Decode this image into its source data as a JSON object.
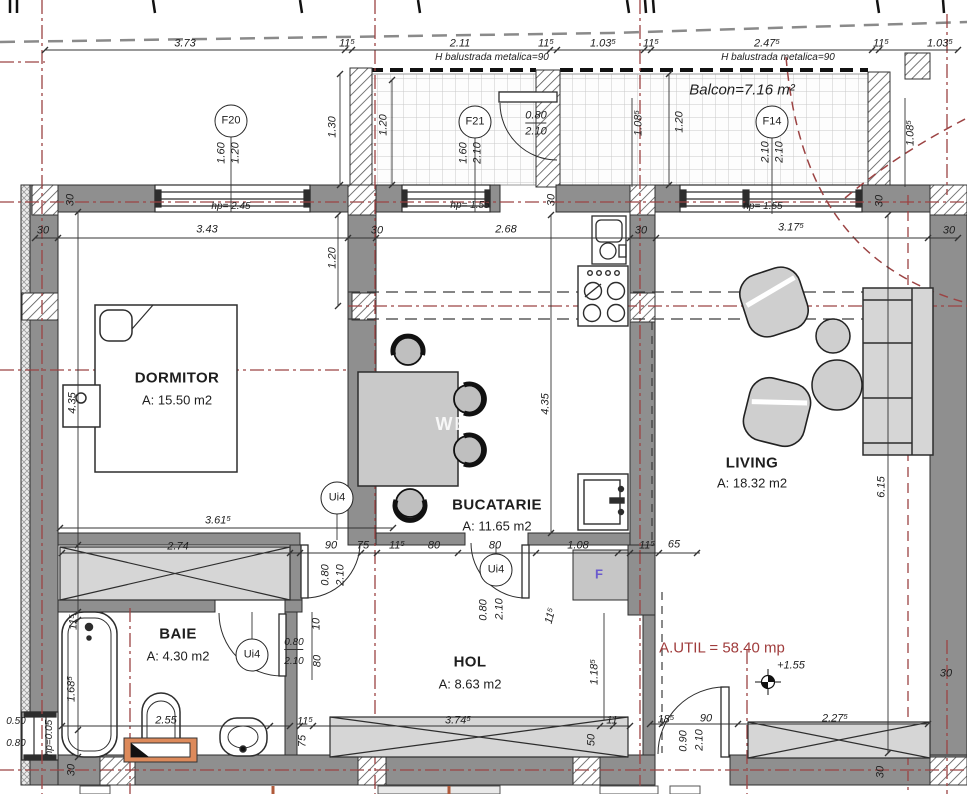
{
  "plan": {
    "rooms": [
      {
        "name": "DORMITOR",
        "area": "A: 15.50 m2"
      },
      {
        "name": "BUCATARIE",
        "area": "A: 11.65 m2"
      },
      {
        "name": "LIVING",
        "area": "A: 18.32 m2"
      },
      {
        "name": "BAIE",
        "area": "A: 4.30 m2"
      },
      {
        "name": "HOL",
        "area": "A: 8.63 m2"
      }
    ],
    "balcony": "Balcon=7.16 m²",
    "total_usable_area": "A.UTIL = 58.40 mp",
    "level_mark": "+1.55",
    "colors": {
      "wall": "#8f8f8f",
      "axis_red": "#9c4343",
      "vanity_orange": "#dd8a5b",
      "fridge_letter": "#6a5acd"
    }
  },
  "labels": [
    {
      "t": "3.73",
      "x": 185,
      "y": 44,
      "k": "dim"
    },
    {
      "t": "11⁵",
      "x": 347,
      "y": 44,
      "k": "dim"
    },
    {
      "t": "2.11",
      "x": 460,
      "y": 44,
      "k": "dim"
    },
    {
      "t": "11⁵",
      "x": 546,
      "y": 44,
      "k": "dim"
    },
    {
      "t": "1.03⁵",
      "x": 603,
      "y": 44,
      "k": "dim"
    },
    {
      "t": "11⁵",
      "x": 651,
      "y": 44,
      "k": "dim"
    },
    {
      "t": "2.47⁵",
      "x": 767,
      "y": 44,
      "k": "dim"
    },
    {
      "t": "11⁵",
      "x": 881,
      "y": 44,
      "k": "dim"
    },
    {
      "t": "1.03⁵",
      "x": 940,
      "y": 44,
      "k": "dim"
    },
    {
      "t": "H balustrada metalica=90",
      "x": 492,
      "y": 58,
      "k": "small"
    },
    {
      "t": "H balustrada metalica=90",
      "x": 778,
      "y": 58,
      "k": "small"
    },
    {
      "t": "Balcon=7.16 m²",
      "x": 742,
      "y": 90,
      "k": "balcony"
    },
    {
      "t": "F20",
      "x": 231,
      "y": 121,
      "k": "marker"
    },
    {
      "t": "F21",
      "x": 475,
      "y": 122,
      "k": "marker"
    },
    {
      "t": "F14",
      "x": 772,
      "y": 122,
      "k": "marker"
    },
    {
      "t": "1.60",
      "x": 222,
      "y": 153,
      "r": -90,
      "k": "dim"
    },
    {
      "t": "1.20",
      "x": 236,
      "y": 153,
      "r": -90,
      "k": "dim"
    },
    {
      "t": "1.60",
      "x": 464,
      "y": 153,
      "r": -90,
      "k": "dim"
    },
    {
      "t": "2.10",
      "x": 478,
      "y": 153,
      "r": -90,
      "k": "dim"
    },
    {
      "t": "2.10",
      "x": 766,
      "y": 152,
      "r": -90,
      "k": "dim"
    },
    {
      "t": "2.10",
      "x": 780,
      "y": 152,
      "r": -90,
      "k": "dim"
    },
    {
      "t": "1.30",
      "x": 333,
      "y": 127,
      "r": -90,
      "k": "dim"
    },
    {
      "t": "1.20",
      "x": 384,
      "y": 125,
      "r": -90,
      "k": "dim"
    },
    {
      "t": "1.20",
      "x": 680,
      "y": 122,
      "r": -90,
      "k": "dim"
    },
    {
      "t": "1.08⁵",
      "x": 639,
      "y": 123,
      "r": -90,
      "k": "dim"
    },
    {
      "t": "1.08⁵",
      "x": 911,
      "y": 133,
      "r": -90,
      "k": "dim"
    },
    {
      "t": "0.80",
      "x": 536,
      "y": 117,
      "k": "dim fractop"
    },
    {
      "t": "2.10",
      "x": 536,
      "y": 132,
      "k": "dim"
    },
    {
      "t": "hp= 2.45",
      "x": 231,
      "y": 207,
      "k": "small"
    },
    {
      "t": "hp= 1.55",
      "x": 470,
      "y": 206,
      "k": "small"
    },
    {
      "t": "hp= 1.55",
      "x": 763,
      "y": 207,
      "k": "small"
    },
    {
      "t": "30",
      "x": 43,
      "y": 231,
      "k": "dim"
    },
    {
      "t": "3.43",
      "x": 207,
      "y": 230,
      "k": "dim"
    },
    {
      "t": "30",
      "x": 377,
      "y": 231,
      "k": "dim"
    },
    {
      "t": "2.68",
      "x": 506,
      "y": 230,
      "k": "dim"
    },
    {
      "t": "30",
      "x": 641,
      "y": 231,
      "k": "dim"
    },
    {
      "t": "3.17⁵",
      "x": 791,
      "y": 228,
      "k": "dim"
    },
    {
      "t": "30",
      "x": 949,
      "y": 231,
      "k": "dim"
    },
    {
      "t": "30",
      "x": 71,
      "y": 200,
      "r": -90,
      "k": "dim"
    },
    {
      "t": "30",
      "x": 552,
      "y": 200,
      "r": -90,
      "k": "dim"
    },
    {
      "t": "30",
      "x": 880,
      "y": 201,
      "r": -90,
      "k": "dim"
    },
    {
      "t": "30",
      "x": 72,
      "y": 770,
      "r": -90,
      "k": "dim"
    },
    {
      "t": "30",
      "x": 881,
      "y": 772,
      "r": -90,
      "k": "dim"
    },
    {
      "t": "30",
      "x": 946,
      "y": 674,
      "k": "dim"
    },
    {
      "t": "1.20",
      "x": 333,
      "y": 258,
      "r": -90,
      "k": "dim"
    },
    {
      "t": "4.35",
      "x": 73,
      "y": 403,
      "r": -90,
      "k": "dim"
    },
    {
      "t": "4.35",
      "x": 546,
      "y": 404,
      "r": -90,
      "k": "dim"
    },
    {
      "t": "6.15",
      "x": 882,
      "y": 487,
      "r": -90,
      "k": "dim"
    },
    {
      "t": "DORMITOR",
      "x": 177,
      "y": 378,
      "k": "room"
    },
    {
      "t": "A: 15.50 m2",
      "x": 177,
      "y": 400,
      "k": "area"
    },
    {
      "t": "BUCATARIE",
      "x": 497,
      "y": 505,
      "k": "room"
    },
    {
      "t": "A: 11.65 m2",
      "x": 497,
      "y": 526,
      "k": "area"
    },
    {
      "t": "LIVING",
      "x": 752,
      "y": 463,
      "k": "room"
    },
    {
      "t": "A: 18.32 m2",
      "x": 752,
      "y": 483,
      "k": "area"
    },
    {
      "t": "BAIE",
      "x": 178,
      "y": 634,
      "k": "room"
    },
    {
      "t": "A: 4.30 m2",
      "x": 178,
      "y": 656,
      "k": "area"
    },
    {
      "t": "HOL",
      "x": 470,
      "y": 662,
      "k": "room"
    },
    {
      "t": "A: 8.63 m2",
      "x": 470,
      "y": 684,
      "k": "area"
    },
    {
      "t": "A.UTIL = 58.40 mp",
      "x": 722,
      "y": 648,
      "k": "red"
    },
    {
      "t": "+1.55",
      "x": 791,
      "y": 666,
      "k": "dim"
    },
    {
      "t": "Ui4",
      "x": 337,
      "y": 498,
      "k": "marker"
    },
    {
      "t": "Ui4",
      "x": 496,
      "y": 570,
      "k": "marker"
    },
    {
      "t": "Ui4",
      "x": 252,
      "y": 655,
      "k": "marker"
    },
    {
      "t": "3.61⁵",
      "x": 218,
      "y": 521,
      "k": "dim"
    },
    {
      "t": "2.74",
      "x": 178,
      "y": 547,
      "k": "dim"
    },
    {
      "t": "90",
      "x": 331,
      "y": 546,
      "k": "dim"
    },
    {
      "t": "75",
      "x": 363,
      "y": 546,
      "k": "dim"
    },
    {
      "t": "11⁵",
      "x": 397,
      "y": 546,
      "k": "dim"
    },
    {
      "t": "80",
      "x": 434,
      "y": 546,
      "k": "dim"
    },
    {
      "t": "80",
      "x": 495,
      "y": 546,
      "k": "dim"
    },
    {
      "t": "1.08",
      "x": 578,
      "y": 546,
      "k": "dim"
    },
    {
      "t": "11⁵",
      "x": 647,
      "y": 546,
      "k": "dim"
    },
    {
      "t": "65",
      "x": 674,
      "y": 545,
      "k": "dim"
    },
    {
      "t": "0.80",
      "x": 326,
      "y": 575,
      "r": -90,
      "k": "dim"
    },
    {
      "t": "2.10",
      "x": 341,
      "y": 575,
      "r": -90,
      "k": "dim"
    },
    {
      "t": "0.80",
      "x": 484,
      "y": 610,
      "r": -90,
      "k": "dim"
    },
    {
      "t": "2.10",
      "x": 500,
      "y": 609,
      "r": -90,
      "k": "dim"
    },
    {
      "t": "0.80",
      "x": 294,
      "y": 644,
      "k": "small fractop"
    },
    {
      "t": "2.10",
      "x": 294,
      "y": 662,
      "k": "small"
    },
    {
      "t": "0.90",
      "x": 684,
      "y": 741,
      "r": -90,
      "k": "dim"
    },
    {
      "t": "2.10",
      "x": 700,
      "y": 740,
      "r": -90,
      "k": "dim"
    },
    {
      "t": "11⁵",
      "x": 74,
      "y": 622,
      "r": -90,
      "k": "dim"
    },
    {
      "t": "1.68⁵",
      "x": 72,
      "y": 689,
      "r": -90,
      "k": "dim"
    },
    {
      "t": "2.55",
      "x": 166,
      "y": 721,
      "k": "dim"
    },
    {
      "t": "hp=0.05",
      "x": 50,
      "y": 738,
      "r": -90,
      "k": "small"
    },
    {
      "t": "0.50",
      "x": 16,
      "y": 722,
      "k": "small"
    },
    {
      "t": "0.80",
      "x": 16,
      "y": 744,
      "k": "small"
    },
    {
      "t": "10",
      "x": 317,
      "y": 624,
      "r": -90,
      "k": "dim"
    },
    {
      "t": "80",
      "x": 318,
      "y": 661,
      "r": -90,
      "k": "dim"
    },
    {
      "t": "11⁵",
      "x": 551,
      "y": 616,
      "r": -75,
      "k": "dim"
    },
    {
      "t": "1.18⁵",
      "x": 595,
      "y": 672,
      "r": -90,
      "k": "dim"
    },
    {
      "t": "3.74⁵",
      "x": 458,
      "y": 721,
      "k": "dim"
    },
    {
      "t": "11⁵",
      "x": 305,
      "y": 722,
      "k": "dim"
    },
    {
      "t": "50",
      "x": 592,
      "y": 740,
      "r": -90,
      "k": "dim"
    },
    {
      "t": "75",
      "x": 303,
      "y": 741,
      "r": -90,
      "k": "dim"
    },
    {
      "t": "18⁵",
      "x": 666,
      "y": 720,
      "k": "dim"
    },
    {
      "t": "90",
      "x": 706,
      "y": 719,
      "k": "dim"
    },
    {
      "t": "2.27⁵",
      "x": 835,
      "y": 719,
      "k": "dim"
    },
    {
      "t": "11",
      "x": 612,
      "y": 721,
      "k": "dim"
    },
    {
      "t": "F",
      "x": 599,
      "y": 574,
      "k": "fridge"
    },
    {
      "t": "WE",
      "x": 452,
      "y": 424,
      "k": "wm"
    }
  ]
}
